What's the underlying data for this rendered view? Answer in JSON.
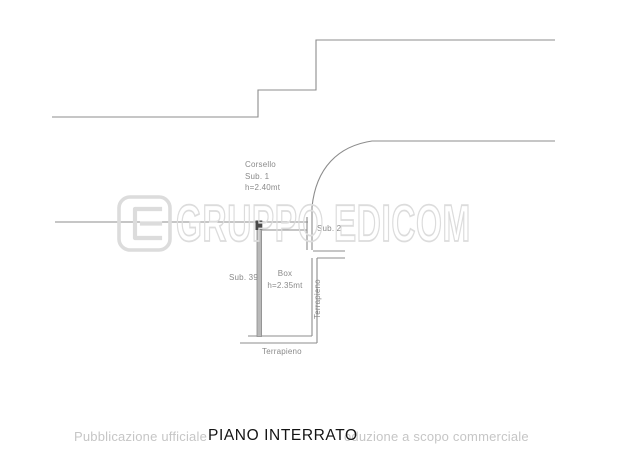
{
  "plan": {
    "labels": {
      "corsello_line1": "Corsello",
      "corsello_line2": "Sub. 1",
      "corsello_line3": "h=2.40mt",
      "sub2": "Sub. 2",
      "sub39": "Sub. 39",
      "box_line1": "Box",
      "box_line2": "h=2.35mt",
      "terrapieno_right": "Terrapieno",
      "terrapieno_bottom": "Terrapieno"
    },
    "colors": {
      "line": "#8c8c8c",
      "label": "#8a8a8a",
      "wall_fill": "#b9b9b9",
      "door_marker": "#4a4a4a"
    }
  },
  "watermark": {
    "logo_text": "GRUPPO EDICOM",
    "logo_icon": "edicom-e-icon",
    "outline_color": "#dcdcdc",
    "bottom_left_text": "Pubblicazione ufficiale",
    "bottom_right_text": "oduzione a scopo commerciale",
    "bottom_color": "#c6c6c6"
  },
  "title": {
    "text": "PIANO INTERRATO",
    "color": "#141414"
  }
}
